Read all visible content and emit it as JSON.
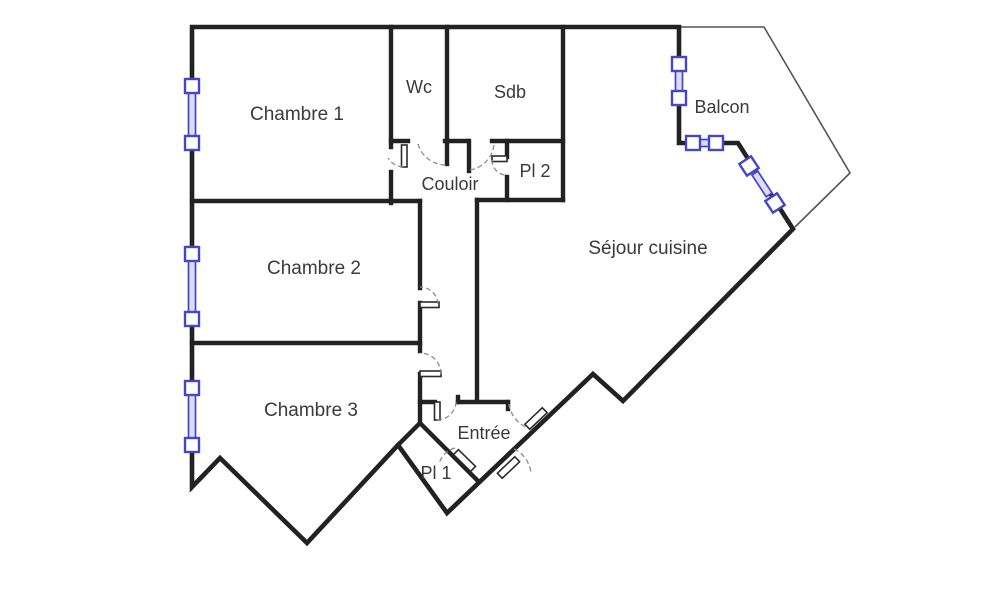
{
  "plan": {
    "type": "apartment-floor-plan",
    "colors": {
      "wall": "#222222",
      "balcony_outline": "#555555",
      "window_frame": "#4545c8",
      "window_fill": "#dcdcf7",
      "door_leaf_fill": "#ffffff",
      "door_arc": "#8c8c8c",
      "label_text": "#3a3a3a",
      "background": "#ffffff"
    },
    "rooms": [
      {
        "id": "chambre-1",
        "label": "Chambre 1"
      },
      {
        "id": "wc",
        "label": "Wc"
      },
      {
        "id": "sdb",
        "label": "Sdb"
      },
      {
        "id": "balcon",
        "label": "Balcon"
      },
      {
        "id": "couloir",
        "label": "Couloir"
      },
      {
        "id": "pl-2",
        "label": "Pl 2"
      },
      {
        "id": "sejour-cuisine",
        "label": "Séjour cuisine"
      },
      {
        "id": "chambre-2",
        "label": "Chambre 2"
      },
      {
        "id": "chambre-3",
        "label": "Chambre 3"
      },
      {
        "id": "entree",
        "label": "Entrée"
      },
      {
        "id": "pl-1",
        "label": "Pl 1"
      }
    ],
    "windows": [
      {
        "id": "window-chambre-1",
        "wall": "left"
      },
      {
        "id": "window-chambre-2",
        "wall": "left"
      },
      {
        "id": "window-chambre-3",
        "wall": "left"
      },
      {
        "id": "window-balcon-vertical",
        "wall": "balcony"
      },
      {
        "id": "window-balcon-horizontal",
        "wall": "balcony"
      },
      {
        "id": "window-balcon-diagonal",
        "wall": "balcony"
      }
    ],
    "doors": [
      {
        "id": "door-chambre-1"
      },
      {
        "id": "door-wc"
      },
      {
        "id": "door-sdb"
      },
      {
        "id": "door-pl-2"
      },
      {
        "id": "door-chambre-2"
      },
      {
        "id": "door-chambre-3"
      },
      {
        "id": "door-couloir-entree"
      },
      {
        "id": "door-entree-principale"
      },
      {
        "id": "door-entree-secondaire"
      },
      {
        "id": "door-pl-1"
      }
    ]
  }
}
